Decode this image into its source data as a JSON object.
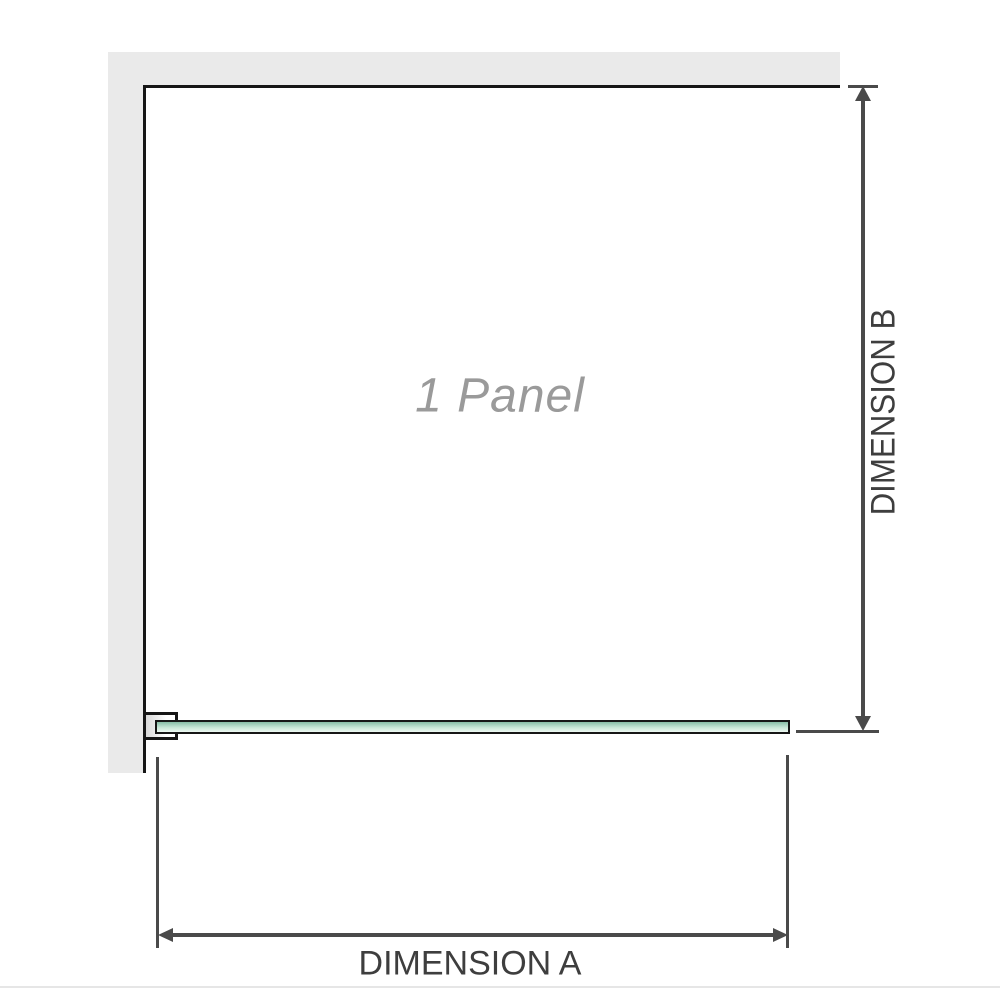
{
  "diagram": {
    "panel_label": "1 Panel",
    "dimension_a": {
      "label": "DIMENSION A"
    },
    "dimension_b": {
      "label": "DIMENSION B"
    }
  },
  "colors": {
    "wall": "#eaeaea",
    "outline": "#161616",
    "glass_top": "#86bda6",
    "glass_bottom": "#edf8f2",
    "dimension": "#4a4a4a",
    "panel_text": "#9a9a9a",
    "label_text": "#3e3e3e",
    "baseline": "#e6e6e6"
  }
}
